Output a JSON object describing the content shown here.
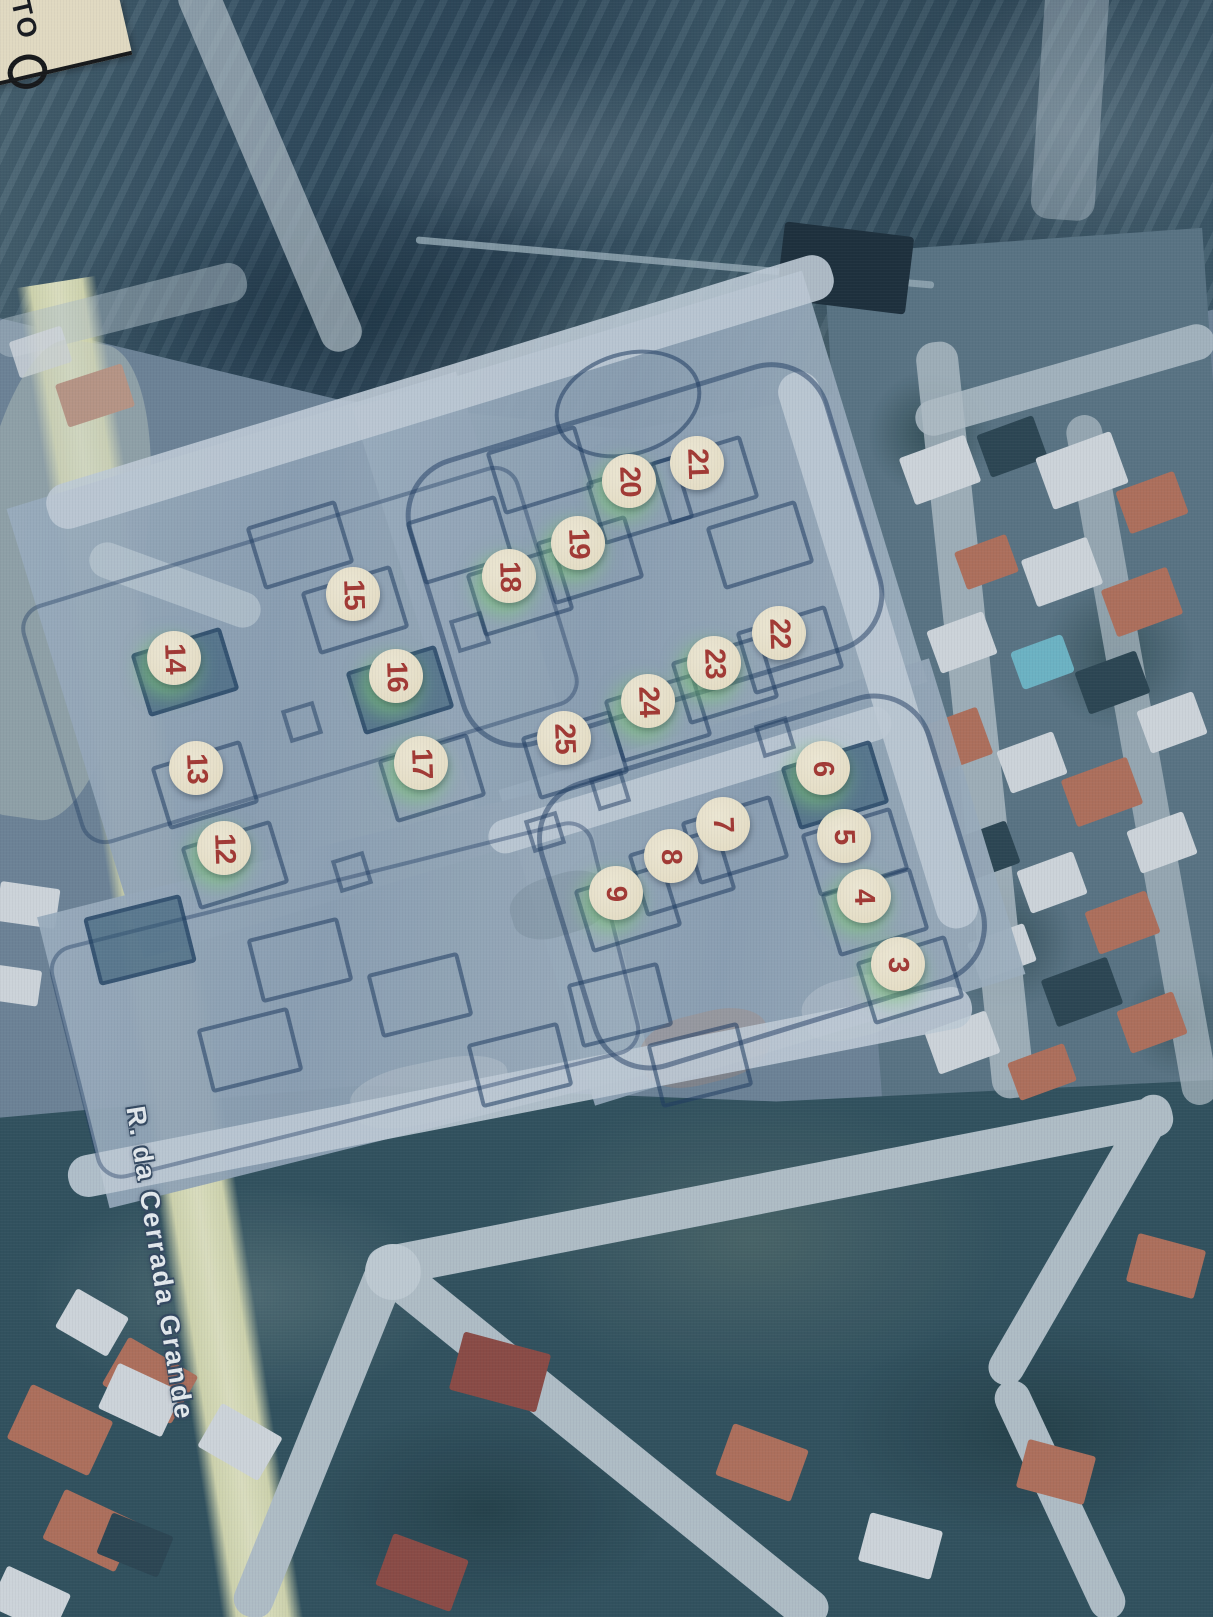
{
  "scene": {
    "street_label": "R. da Cerrada Grande",
    "corner_label": "TO",
    "colors": {
      "marker_bg": "#f3e9cf",
      "marker_number": "#a93730",
      "marker_green_halo": "#80d076",
      "street_label_text": "#eef3f5",
      "left_road": "#d7dab0",
      "plan_surface": "#9aadbf",
      "plan_lines": "#1f3a60"
    },
    "lot_markers": [
      {
        "number": "3",
        "x": 898,
        "y": 964,
        "green_halo": true
      },
      {
        "number": "4",
        "x": 864,
        "y": 896,
        "green_halo": true
      },
      {
        "number": "5",
        "x": 844,
        "y": 836,
        "green_halo": false
      },
      {
        "number": "6",
        "x": 823,
        "y": 768,
        "green_halo": true
      },
      {
        "number": "7",
        "x": 723,
        "y": 824,
        "green_halo": false
      },
      {
        "number": "8",
        "x": 671,
        "y": 856,
        "green_halo": false
      },
      {
        "number": "9",
        "x": 616,
        "y": 893,
        "green_halo": true
      },
      {
        "number": "12",
        "x": 224,
        "y": 848,
        "green_halo": true
      },
      {
        "number": "13",
        "x": 196,
        "y": 768,
        "green_halo": false
      },
      {
        "number": "14",
        "x": 174,
        "y": 658,
        "green_halo": true
      },
      {
        "number": "15",
        "x": 353,
        "y": 594,
        "green_halo": false
      },
      {
        "number": "16",
        "x": 396,
        "y": 676,
        "green_halo": true
      },
      {
        "number": "17",
        "x": 421,
        "y": 763,
        "green_halo": true
      },
      {
        "number": "18",
        "x": 509,
        "y": 576,
        "green_halo": true
      },
      {
        "number": "19",
        "x": 578,
        "y": 543,
        "green_halo": true
      },
      {
        "number": "20",
        "x": 629,
        "y": 481,
        "green_halo": true
      },
      {
        "number": "21",
        "x": 697,
        "y": 463,
        "green_halo": false
      },
      {
        "number": "22",
        "x": 779,
        "y": 633,
        "green_halo": false
      },
      {
        "number": "23",
        "x": 714,
        "y": 663,
        "green_halo": true
      },
      {
        "number": "24",
        "x": 648,
        "y": 701,
        "green_halo": true
      },
      {
        "number": "25",
        "x": 564,
        "y": 738,
        "green_halo": false
      }
    ]
  }
}
